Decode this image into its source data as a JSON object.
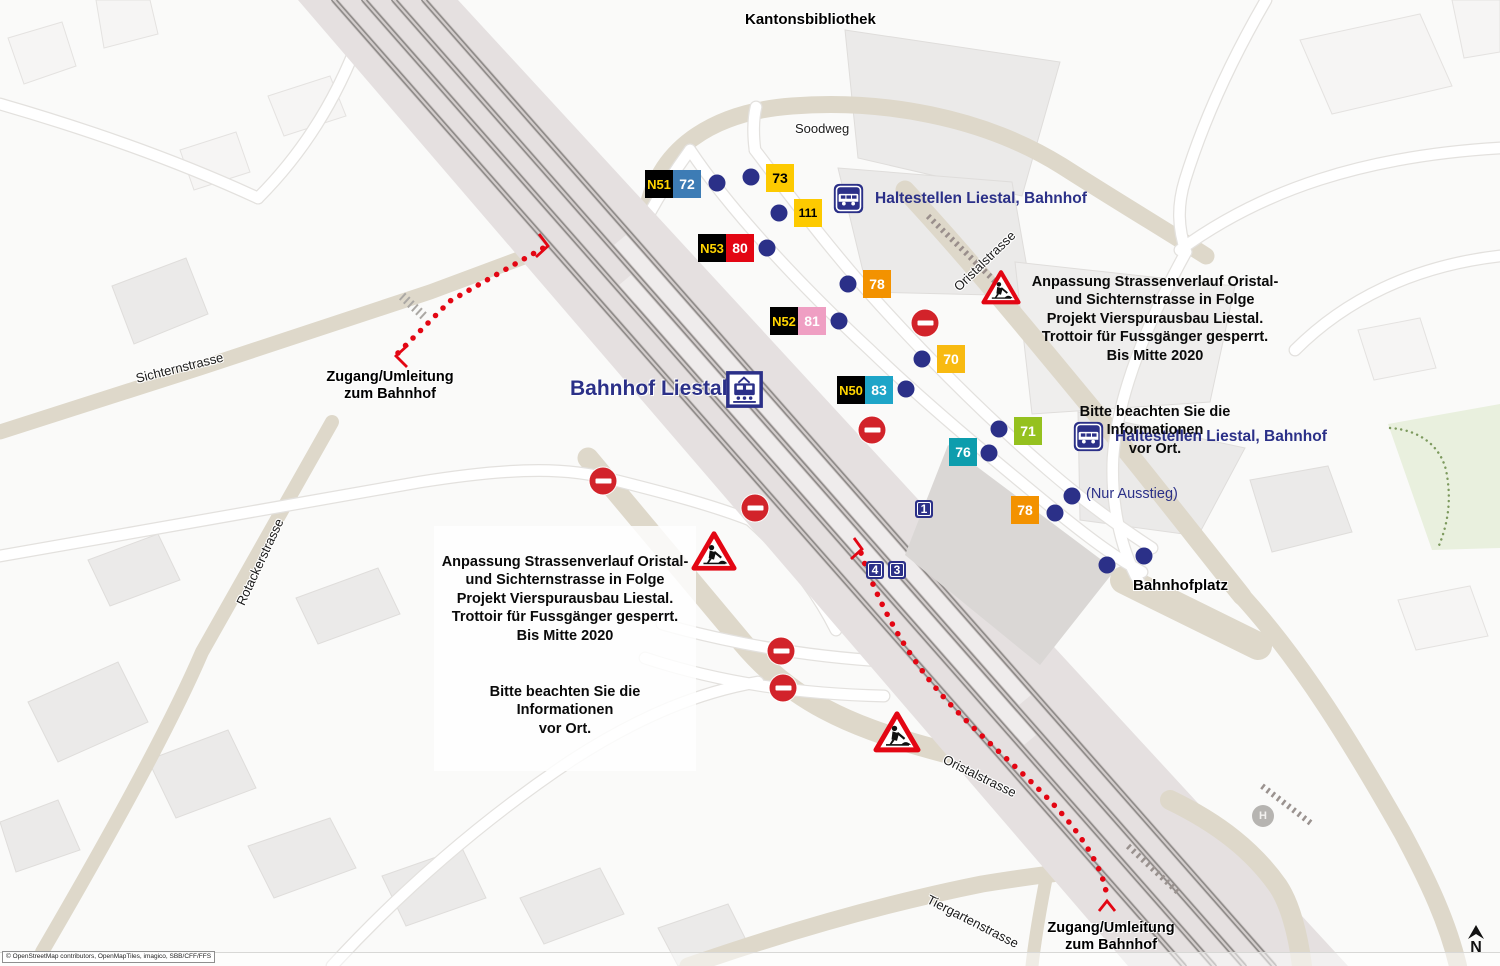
{
  "station": {
    "name": "Bahnhof Liestal"
  },
  "colors": {
    "navy": "#2b3088",
    "detour_red": "#e30613",
    "sign_red": "#d2232a",
    "night_badge_bg": "#000000",
    "night_badge_text": "#ffd400",
    "road_beige": "#ded8ca",
    "building_grey": "#ebeae9",
    "rail_band": "#e5e0e0",
    "park_green": "#e9f0de"
  },
  "haltestellen": [
    {
      "text": "Haltestellen Liestal, Bahnhof"
    },
    {
      "text": "Haltestellen Liestal, Bahnhof"
    }
  ],
  "nur_ausstieg": {
    "text": "(Nur Ausstieg)"
  },
  "info_boxes": [
    {
      "para1": "Anpassung Strassenverlauf Oristal-\nund Sichternstrasse in Folge\nProjekt Vierspurausbau Liestal.\nTrottoir für Fussgänger gesperrt.\nBis Mitte 2020",
      "para2": "Bitte beachten Sie die Informationen\nvor Ort."
    },
    {
      "para1": "Anpassung Strassenverlauf Oristal-\nund Sichternstrasse in Folge\nProjekt Vierspurausbau Liestal.\nTrottoir für Fussgänger gesperrt.\nBis Mitte 2020",
      "para2": "Bitte beachten Sie die Informationen\nvor Ort."
    }
  ],
  "detour_labels": [
    {
      "text": "Zugang/Umleitung\nzum Bahnhof"
    },
    {
      "text": "Zugang/Umleitung\nzum Bahnhof"
    }
  ],
  "street_labels": [
    {
      "text": "Kantonsbibliothek",
      "x": 745,
      "y": 12,
      "rotate": 0,
      "bold": true,
      "size": 15
    },
    {
      "text": "Soodweg",
      "x": 795,
      "y": 122,
      "rotate": 0,
      "bold": false,
      "size": 13
    },
    {
      "text": "Sichternstrasse",
      "x": 136,
      "y": 372,
      "rotate": -14,
      "bold": false,
      "size": 13
    },
    {
      "text": "Rotackerstrasse",
      "x": 240,
      "y": 598,
      "rotate": -65,
      "bold": false,
      "size": 13
    },
    {
      "text": "Oristalstrasse",
      "x": 956,
      "y": 282,
      "rotate": -44,
      "bold": false,
      "size": 13
    },
    {
      "text": "Oristalstrasse",
      "x": 944,
      "y": 752,
      "rotate": 26,
      "bold": false,
      "size": 13
    },
    {
      "text": "Bahnhofplatz",
      "x": 1133,
      "y": 578,
      "rotate": 0,
      "bold": true,
      "size": 15
    },
    {
      "text": "Tiergartenstrasse",
      "x": 928,
      "y": 892,
      "rotate": 27,
      "bold": false,
      "size": 13
    }
  ],
  "bus_badges": [
    {
      "night": "N51",
      "line": "72",
      "color": "#3d7cb5",
      "text_color": "#ffffff",
      "x": 673,
      "y": 170
    },
    {
      "line": "73",
      "color": "#fdca00",
      "text_color": "#000000",
      "x": 766,
      "y": 164
    },
    {
      "line": "111",
      "color": "#fdca00",
      "text_color": "#000000",
      "x": 794,
      "y": 199
    },
    {
      "night": "N53",
      "line": "80",
      "color": "#e30613",
      "text_color": "#ffffff",
      "x": 726,
      "y": 234
    },
    {
      "line": "78",
      "color": "#f39200",
      "text_color": "#ffffff",
      "x": 863,
      "y": 270
    },
    {
      "night": "N52",
      "line": "81",
      "color": "#ef9fc3",
      "text_color": "#ffffff",
      "x": 798,
      "y": 307
    },
    {
      "line": "70",
      "color": "#f8ba11",
      "text_color": "#ffffff",
      "x": 937,
      "y": 345
    },
    {
      "night": "N50",
      "line": "83",
      "color": "#1ea5c8",
      "text_color": "#ffffff",
      "x": 865,
      "y": 376
    },
    {
      "line": "71",
      "color": "#95c11f",
      "text_color": "#ffffff",
      "x": 1014,
      "y": 417
    },
    {
      "line": "76",
      "color": "#0d9dad",
      "text_color": "#ffffff",
      "x": 949,
      "y": 438
    },
    {
      "line": "78",
      "color": "#f39200",
      "text_color": "#ffffff",
      "x": 1011,
      "y": 496
    }
  ],
  "platform_signs": [
    {
      "label": "1",
      "x": 924,
      "y": 509
    },
    {
      "label": "4",
      "x": 875,
      "y": 570
    },
    {
      "label": "3",
      "x": 897,
      "y": 570
    }
  ],
  "stop_dots": [
    [
      717,
      183
    ],
    [
      751,
      177
    ],
    [
      779,
      213
    ],
    [
      767,
      248
    ],
    [
      848,
      284
    ],
    [
      839,
      321
    ],
    [
      922,
      359
    ],
    [
      906,
      389
    ],
    [
      999,
      429
    ],
    [
      989,
      453
    ],
    [
      1072,
      496
    ],
    [
      1055,
      513
    ],
    [
      1107,
      565
    ],
    [
      1144,
      556
    ]
  ],
  "no_entry_signs": [
    [
      925,
      323
    ],
    [
      872,
      430
    ],
    [
      603,
      481
    ],
    [
      755,
      508
    ],
    [
      781,
      651
    ],
    [
      783,
      688
    ]
  ],
  "construction_signs": [
    {
      "x": 1001,
      "y": 289,
      "size": 40
    },
    {
      "x": 714,
      "y": 553,
      "size": 46
    },
    {
      "x": 897,
      "y": 734,
      "size": 48
    }
  ],
  "h_stop": {
    "label": "H"
  },
  "north": {
    "label": "N"
  },
  "copyright": {
    "text": "© OpenStreetMap contributors, OpenMapTiles, imagico, SBB/CFF/FFS"
  }
}
